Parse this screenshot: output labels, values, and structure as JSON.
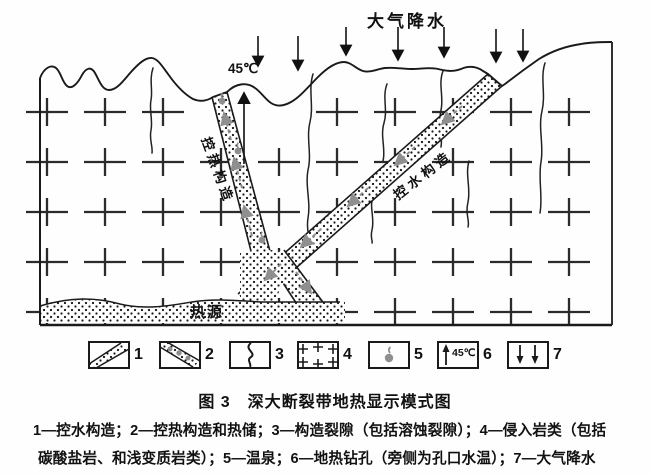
{
  "figure": {
    "precipitation_label": "大气降水",
    "borehole_temp": "45℃",
    "heat_control_label": "控热构造",
    "water_control_label": "控水构造",
    "heat_source_label": "热源"
  },
  "legend": {
    "items": [
      {
        "num": "1",
        "symbol": "diagonal-dotted-band",
        "meaning": "控水构造"
      },
      {
        "num": "2",
        "symbol": "diagonal-blob-band",
        "meaning": "控热构造和热储"
      },
      {
        "num": "3",
        "symbol": "wavy-line",
        "meaning": "构造裂隙"
      },
      {
        "num": "4",
        "symbol": "plus-signs",
        "meaning": "侵入岩类"
      },
      {
        "num": "5",
        "symbol": "droplet",
        "meaning": "温泉"
      },
      {
        "num": "6",
        "symbol": "up-arrow-with-temperature",
        "temp": "45℃",
        "meaning": "地热钻孔"
      },
      {
        "num": "7",
        "symbol": "down-arrows",
        "meaning": "大气降水"
      }
    ]
  },
  "caption": "图 3　深大断裂带地热显示模式图",
  "description": {
    "line1": "1—控水构造；2—控热构造和热储；3—构造裂隙（包括溶蚀裂隙）；4—侵入岩类（包括",
    "line2": "碳酸盐岩、和浅变质岩类）；5—温泉；6—地热钻孔（旁侧为孔口水温）；7—大气降水"
  },
  "colors": {
    "ink": "#1a1a1a",
    "spring_gray": "#8f8f8f"
  }
}
